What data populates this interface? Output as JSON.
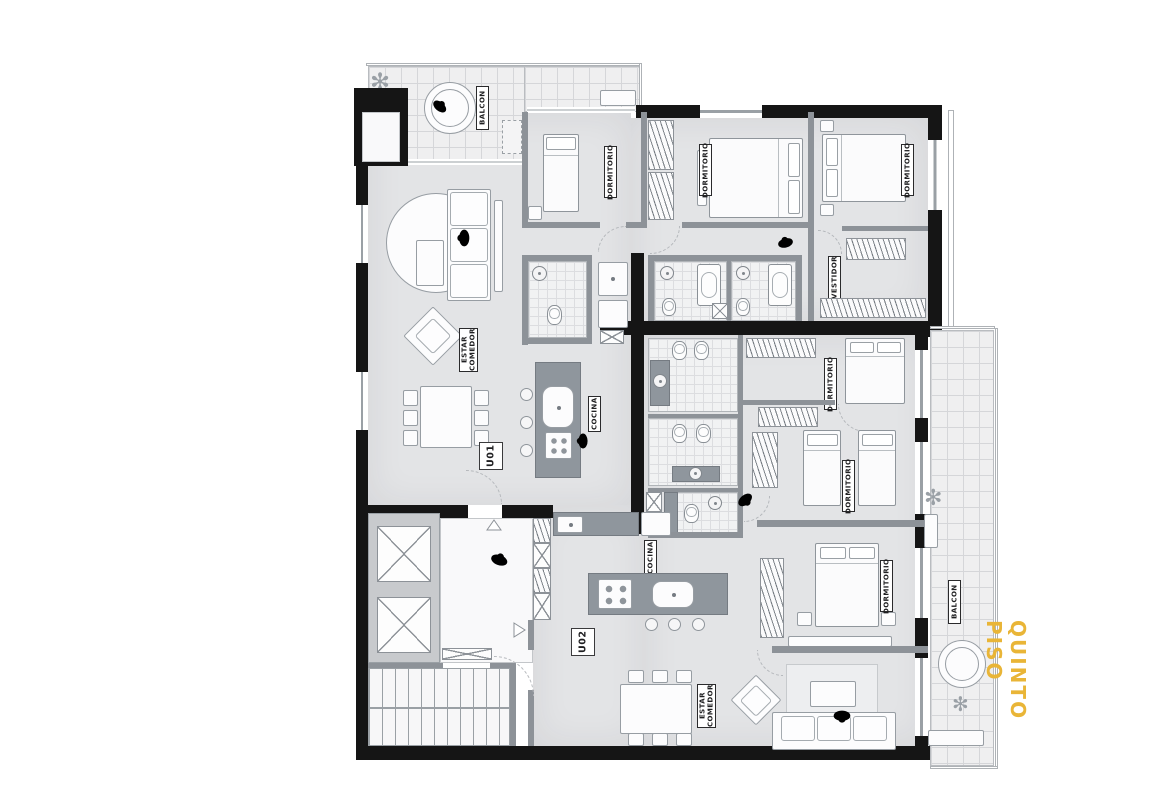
{
  "floor": {
    "title": "QUINTO PISO"
  },
  "units": {
    "u01": "U01",
    "u02": "U02"
  },
  "labels": {
    "balcon_top": "BALCON",
    "balcon_right": "BALCON",
    "dormitorio_u01_a": "DORMITORIO",
    "dormitorio_u01_b": "DORMITORIO",
    "dormitorio_u01_c": "DORMITORIO",
    "vestidor_u01": "VESTIDOR",
    "estar_comedor_u01": "ESTAR COMEDOR",
    "cocina_u01": "COCINA",
    "dormitorio_u02_a": "DORMITORIO",
    "dormitorio_u02_b": "DORMITORIO",
    "dormitorio_u02_c": "DORMITORIO",
    "cocina_u02": "COCINA",
    "estar_comedor_u02": "ESTAR COMEDOR"
  },
  "icons": {
    "plant": "✻"
  },
  "colors": {
    "accent": "#E9B537",
    "wall": "#151515",
    "floor": "#E3E4E6",
    "counter": "#8F969D"
  }
}
